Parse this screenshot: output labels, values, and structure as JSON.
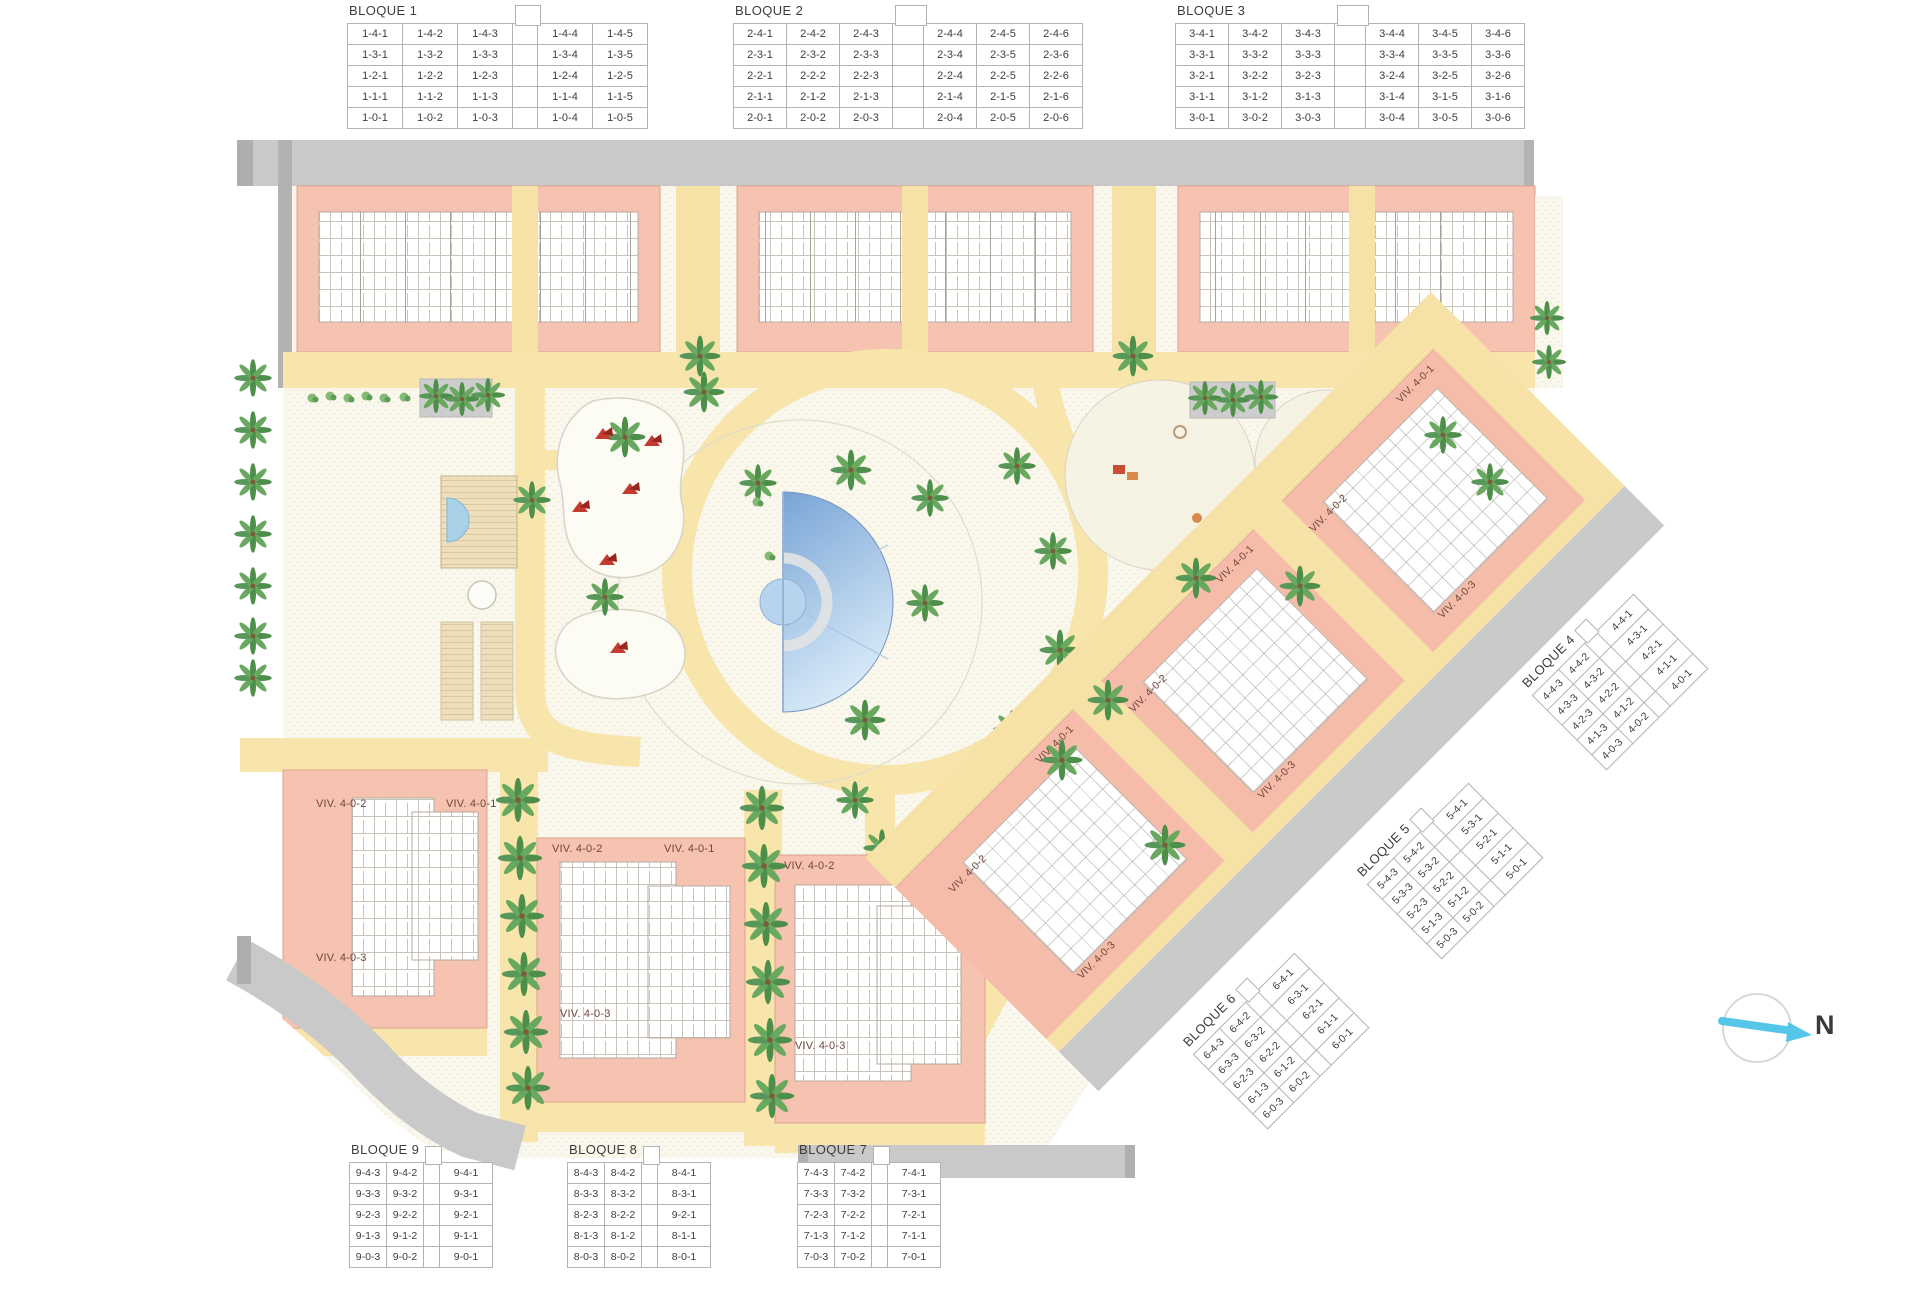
{
  "legend": {
    "b1": {
      "title": "BLOQUE 1",
      "gap_index": 3,
      "rows": [
        [
          "1-4-1",
          "1-4-2",
          "1-4-3",
          "1-4-4",
          "1-4-5"
        ],
        [
          "1-3-1",
          "1-3-2",
          "1-3-3",
          "1-3-4",
          "1-3-5"
        ],
        [
          "1-2-1",
          "1-2-2",
          "1-2-3",
          "1-2-4",
          "1-2-5"
        ],
        [
          "1-1-1",
          "1-1-2",
          "1-1-3",
          "1-1-4",
          "1-1-5"
        ],
        [
          "1-0-1",
          "1-0-2",
          "1-0-3",
          "1-0-4",
          "1-0-5"
        ]
      ]
    },
    "b2": {
      "title": "BLOQUE 2",
      "gap_index": 3,
      "rows": [
        [
          "2-4-1",
          "2-4-2",
          "2-4-3",
          "2-4-4",
          "2-4-5",
          "2-4-6"
        ],
        [
          "2-3-1",
          "2-3-2",
          "2-3-3",
          "2-3-4",
          "2-3-5",
          "2-3-6"
        ],
        [
          "2-2-1",
          "2-2-2",
          "2-2-3",
          "2-2-4",
          "2-2-5",
          "2-2-6"
        ],
        [
          "2-1-1",
          "2-1-2",
          "2-1-3",
          "2-1-4",
          "2-1-5",
          "2-1-6"
        ],
        [
          "2-0-1",
          "2-0-2",
          "2-0-3",
          "2-0-4",
          "2-0-5",
          "2-0-6"
        ]
      ]
    },
    "b3": {
      "title": "BLOQUE 3",
      "gap_index": 3,
      "rows": [
        [
          "3-4-1",
          "3-4-2",
          "3-4-3",
          "3-4-4",
          "3-4-5",
          "3-4-6"
        ],
        [
          "3-3-1",
          "3-3-2",
          "3-3-3",
          "3-3-4",
          "3-3-5",
          "3-3-6"
        ],
        [
          "3-2-1",
          "3-2-2",
          "3-2-3",
          "3-2-4",
          "3-2-5",
          "3-2-6"
        ],
        [
          "3-1-1",
          "3-1-2",
          "3-1-3",
          "3-1-4",
          "3-1-5",
          "3-1-6"
        ],
        [
          "3-0-1",
          "3-0-2",
          "3-0-3",
          "3-0-4",
          "3-0-5",
          "3-0-6"
        ]
      ]
    },
    "b4": {
      "title": "BLOQUE 4",
      "gap_index": 2,
      "rows": [
        [
          "4-4-3",
          "4-4-2",
          "4-4-1"
        ],
        [
          "4-3-3",
          "4-3-2",
          "4-3-1"
        ],
        [
          "4-2-3",
          "4-2-2",
          "4-2-1"
        ],
        [
          "4-1-3",
          "4-1-2",
          "4-1-1"
        ],
        [
          "4-0-3",
          "4-0-2",
          "4-0-1"
        ]
      ]
    },
    "b5": {
      "title": "BLOQUE 5",
      "gap_index": 2,
      "rows": [
        [
          "5-4-3",
          "5-4-2",
          "5-4-1"
        ],
        [
          "5-3-3",
          "5-3-2",
          "5-3-1"
        ],
        [
          "5-2-3",
          "5-2-2",
          "5-2-1"
        ],
        [
          "5-1-3",
          "5-1-2",
          "5-1-1"
        ],
        [
          "5-0-3",
          "5-0-2",
          "5-0-1"
        ]
      ]
    },
    "b6": {
      "title": "BLOQUE 6",
      "gap_index": 2,
      "rows": [
        [
          "6-4-3",
          "6-4-2",
          "6-4-1"
        ],
        [
          "6-3-3",
          "6-3-2",
          "6-3-1"
        ],
        [
          "6-2-3",
          "6-2-2",
          "6-2-1"
        ],
        [
          "6-1-3",
          "6-1-2",
          "6-1-1"
        ],
        [
          "6-0-3",
          "6-0-2",
          "6-0-1"
        ]
      ]
    },
    "b7": {
      "title": "BLOQUE 7",
      "gap_index": 2,
      "rows": [
        [
          "7-4-3",
          "7-4-2",
          "7-4-1"
        ],
        [
          "7-3-3",
          "7-3-2",
          "7-3-1"
        ],
        [
          "7-2-3",
          "7-2-2",
          "7-2-1"
        ],
        [
          "7-1-3",
          "7-1-2",
          "7-1-1"
        ],
        [
          "7-0-3",
          "7-0-2",
          "7-0-1"
        ]
      ]
    },
    "b8": {
      "title": "BLOQUE 8",
      "gap_index": 2,
      "rows": [
        [
          "8-4-3",
          "8-4-2",
          "8-4-1"
        ],
        [
          "8-3-3",
          "8-3-2",
          "8-3-1"
        ],
        [
          "8-2-3",
          "8-2-2",
          "9-2-1"
        ],
        [
          "8-1-3",
          "8-1-2",
          "8-1-1"
        ],
        [
          "8-0-3",
          "8-0-2",
          "8-0-1"
        ]
      ]
    },
    "b9": {
      "title": "BLOQUE 9",
      "gap_index": 2,
      "rows": [
        [
          "9-4-3",
          "9-4-2",
          "9-4-1"
        ],
        [
          "9-3-3",
          "9-3-2",
          "9-3-1"
        ],
        [
          "9-2-3",
          "9-2-2",
          "9-2-1"
        ],
        [
          "9-1-3",
          "9-1-2",
          "9-1-1"
        ],
        [
          "9-0-3",
          "9-0-2",
          "9-0-1"
        ]
      ]
    }
  },
  "unit_labels": {
    "u1": "VIV. 4-0-1",
    "u2": "VIV. 4-0-2",
    "u3": "VIV. 4-0-3"
  },
  "compass": {
    "label": "N"
  },
  "icons": {
    "palm_tree": "svg-palm-burst",
    "shrub": "svg-green-blob",
    "umbrella": "svg-red-triangles",
    "north_arrow": "svg-cyan-arrow"
  },
  "colors": {
    "building_pink": "#f4bca9",
    "townhouse_pink": "#f6c3b0",
    "path_yellow": "#f7e5ab",
    "road_gray": "#c9c9c9",
    "plaza_cream": "#faf7ec",
    "pool_blue_dark": "#78a5d6",
    "pool_blue_light": "#d9eaf8",
    "tree_green": "#4e8e4b",
    "accent_red": "#c63b31",
    "north_arrow_blue": "#55c6ea"
  }
}
